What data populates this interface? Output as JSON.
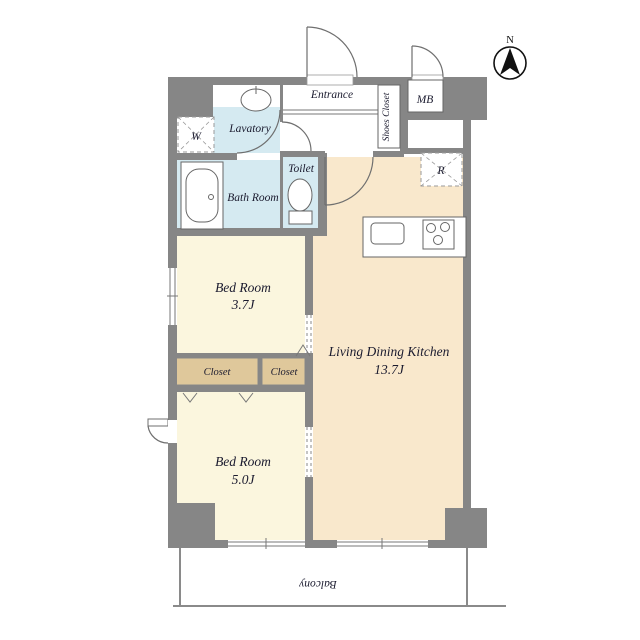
{
  "plan": {
    "north_label": "N",
    "rooms": {
      "entrance": "Entrance",
      "shoes_closet": "Shoes Closet",
      "meter_box": "MB",
      "lavatory": "Lavatory",
      "washer": "W",
      "bath": "Bath Room",
      "toilet": "Toilet",
      "fridge": "R",
      "bedroom1_name": "Bed Room",
      "bedroom1_size": "3.7J",
      "ldk_name": "Living Dining Kitchen",
      "ldk_size": "13.7J",
      "closet_left": "Closet",
      "closet_right": "Closet",
      "bedroom2_name": "Bed Room",
      "bedroom2_size": "5.0J",
      "balcony": "Balcony"
    },
    "colors": {
      "wall": "#868686",
      "bedroom": "#FBF6DE",
      "ldk": "#F9E8CC",
      "wet_area": "#D5EAF1",
      "closet": "#DFC89B",
      "text": "#1A1A2E"
    }
  }
}
